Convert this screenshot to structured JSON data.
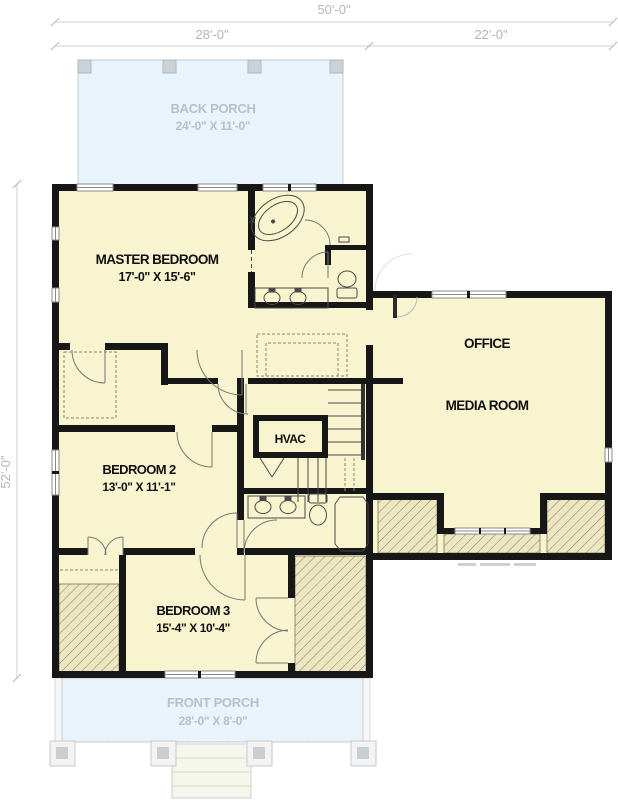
{
  "dimensions": {
    "overall_width": "50'-0\"",
    "left_section_width": "28'-0\"",
    "right_section_width": "22'-0\"",
    "overall_depth": "52'-0\""
  },
  "rooms": {
    "back_porch": {
      "name": "BACK PORCH",
      "size": "24'-0\" X 11'-0\""
    },
    "master_bedroom": {
      "name": "MASTER BEDROOM",
      "size": "17'-0\" X 15'-6\""
    },
    "office": {
      "name": "OFFICE"
    },
    "media_room": {
      "name": "MEDIA ROOM"
    },
    "bedroom_2": {
      "name": "BEDROOM 2",
      "size": "13'-0\" X 11'-1\""
    },
    "hvac": {
      "name": "HVAC"
    },
    "bedroom_3": {
      "name": "BEDROOM 3",
      "size": "15'-4\" X 10'-4\""
    },
    "front_porch": {
      "name": "FRONT PORCH",
      "size": "28'-0\" X 8'-0\""
    }
  },
  "colors": {
    "floor_fill": "#f8f4cf",
    "porch_fill": "#e9f3fb",
    "wall": "#171717",
    "hatch_fill": "#ece7c2",
    "hatch_line": "#8d8760",
    "dimension_text": "#b3b6b9"
  }
}
